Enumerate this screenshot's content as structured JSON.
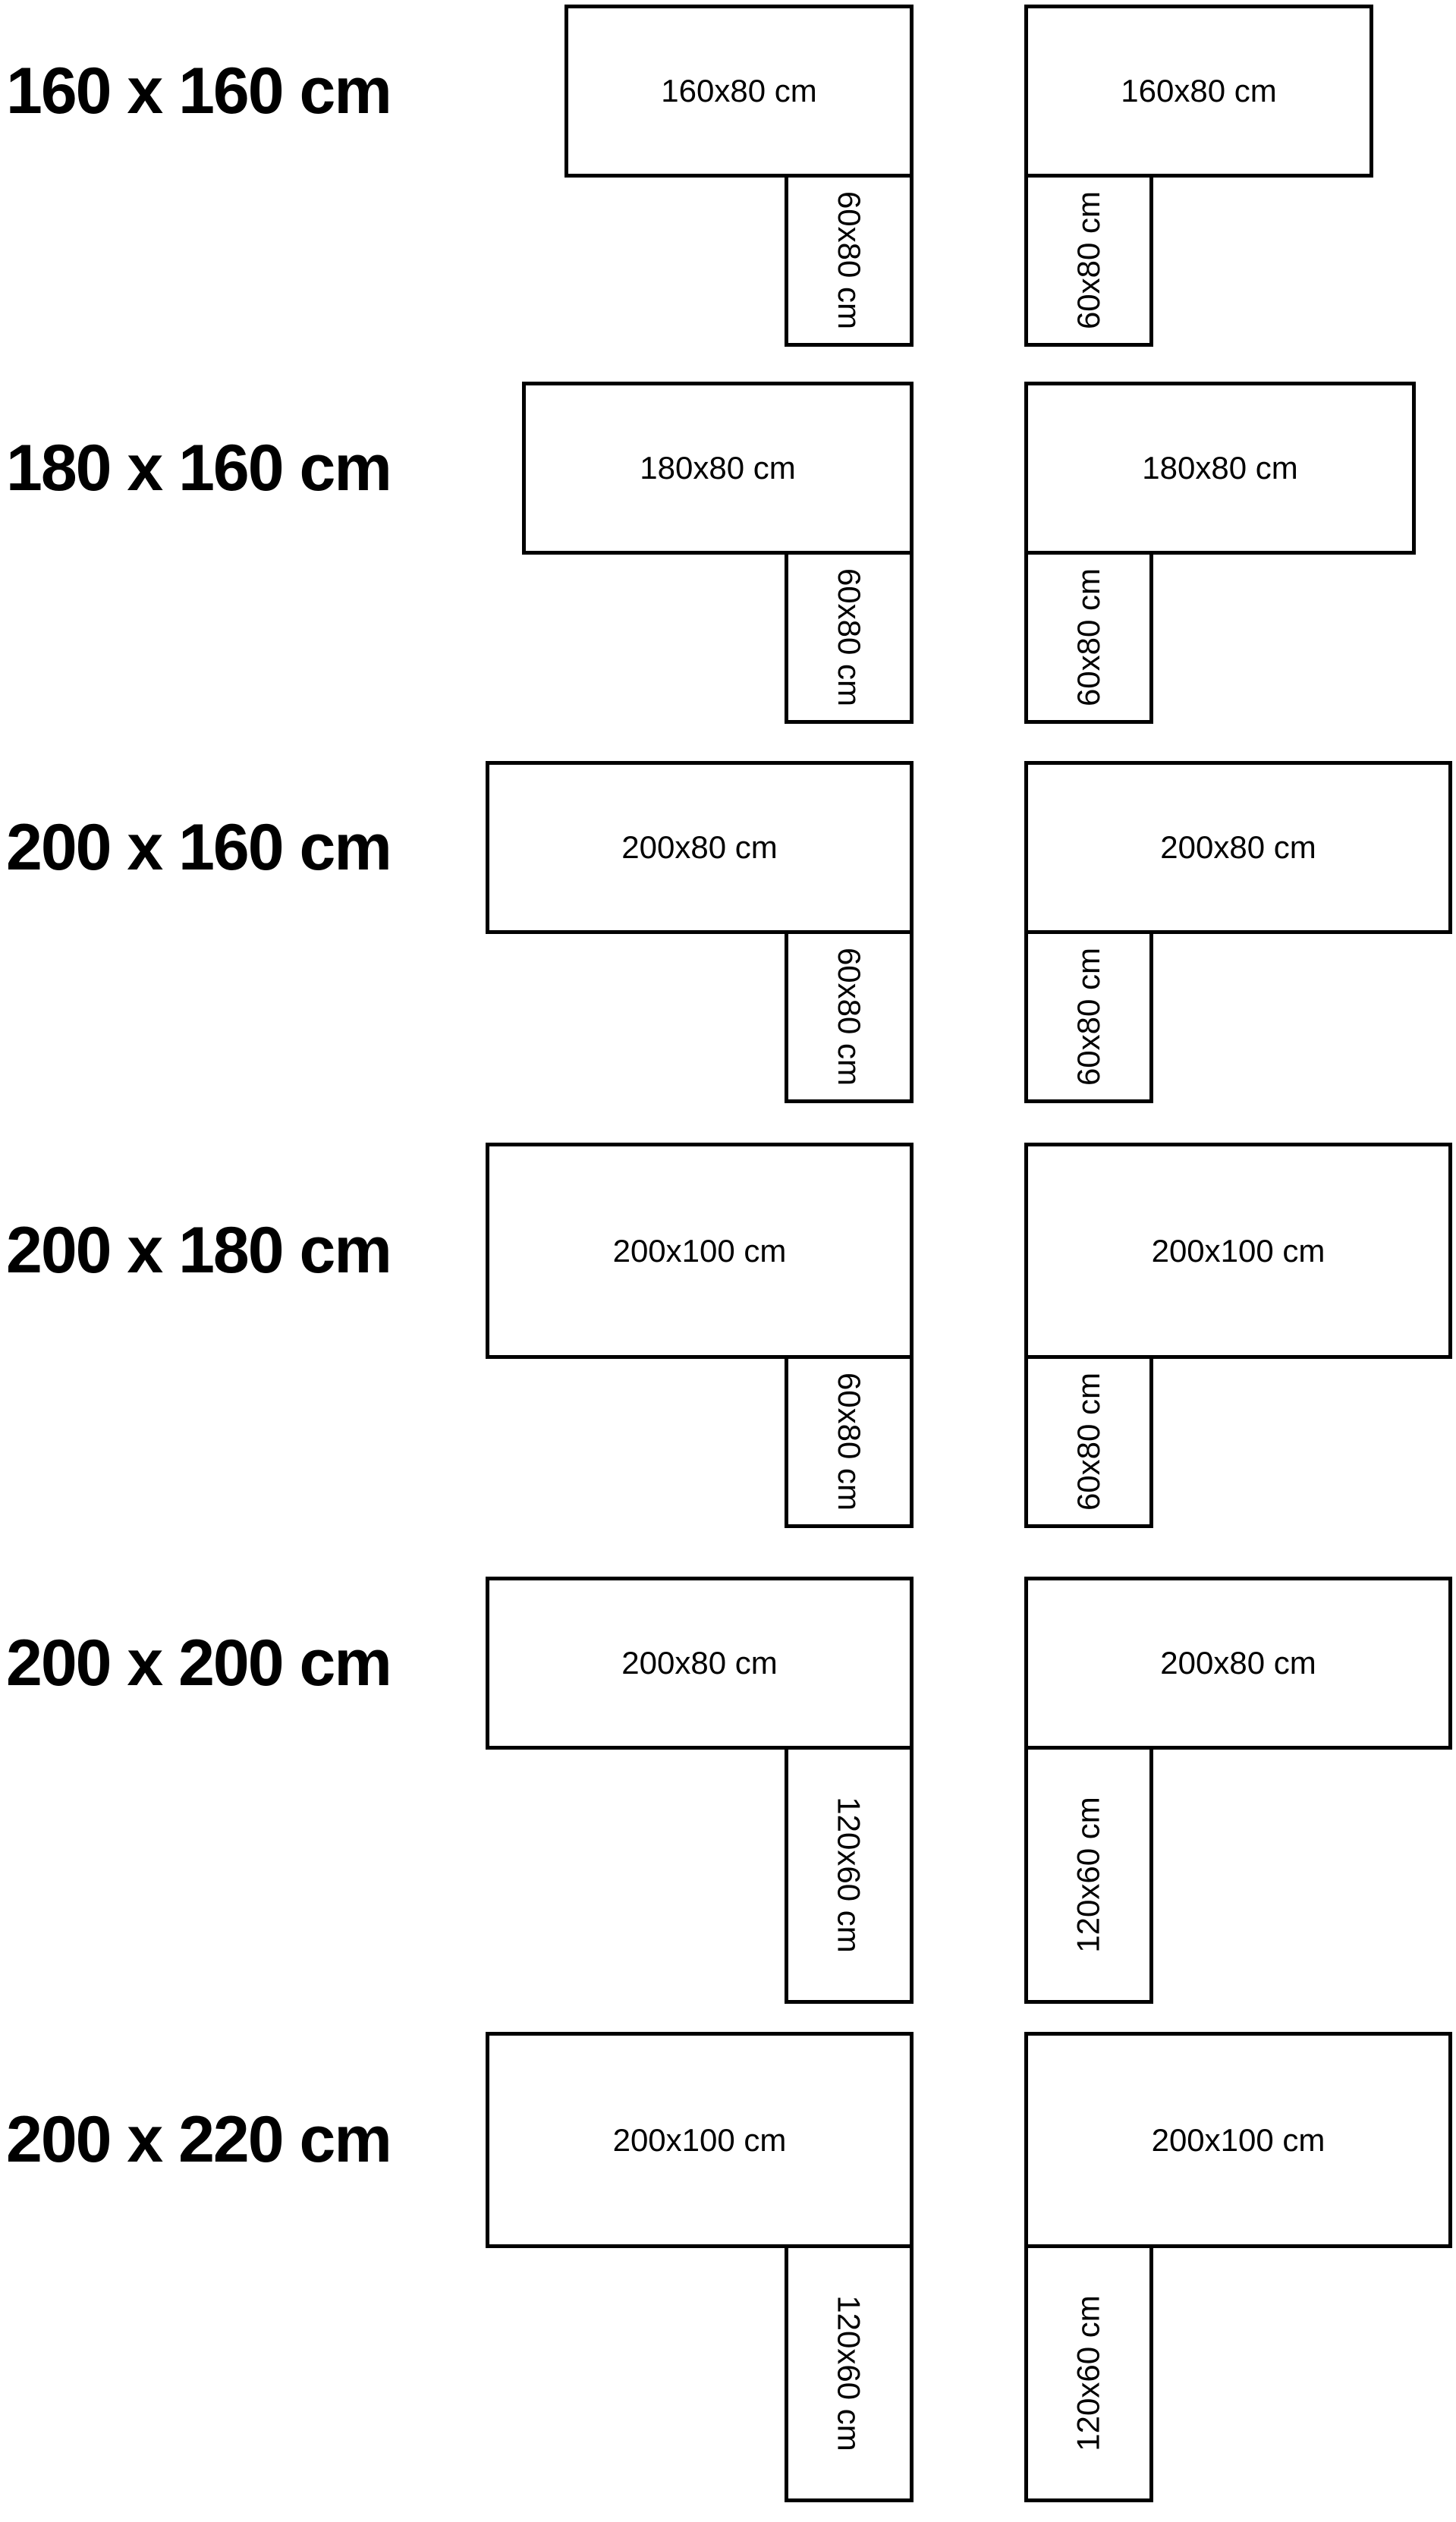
{
  "colors": {
    "background": "#ffffff",
    "stroke": "#000000",
    "text": "#000000"
  },
  "rows": [
    {
      "label": "160 x 160 cm",
      "left": {
        "top": "160x80 cm",
        "side": "60x80 cm"
      },
      "right": {
        "top": "160x80 cm",
        "side": "60x80 cm"
      }
    },
    {
      "label": "180 x 160 cm",
      "left": {
        "top": "180x80 cm",
        "side": "60x80 cm"
      },
      "right": {
        "top": "180x80 cm",
        "side": "60x80 cm"
      }
    },
    {
      "label": "200 x 160 cm",
      "left": {
        "top": "200x80 cm",
        "side": "60x80 cm"
      },
      "right": {
        "top": "200x80 cm",
        "side": "60x80 cm"
      }
    },
    {
      "label": "200 x 180 cm",
      "left": {
        "top": "200x100 cm",
        "side": "60x80 cm"
      },
      "right": {
        "top": "200x100 cm",
        "side": "60x80 cm"
      }
    },
    {
      "label": "200 x 200 cm",
      "left": {
        "top": "200x80 cm",
        "side": "120x60 cm"
      },
      "right": {
        "top": "200x80 cm",
        "side": "120x60 cm"
      }
    },
    {
      "label": "200 x 220 cm",
      "left": {
        "top": "200x100 cm",
        "side": "120x60 cm"
      },
      "right": {
        "top": "200x100 cm",
        "side": "120x60 cm"
      }
    }
  ]
}
